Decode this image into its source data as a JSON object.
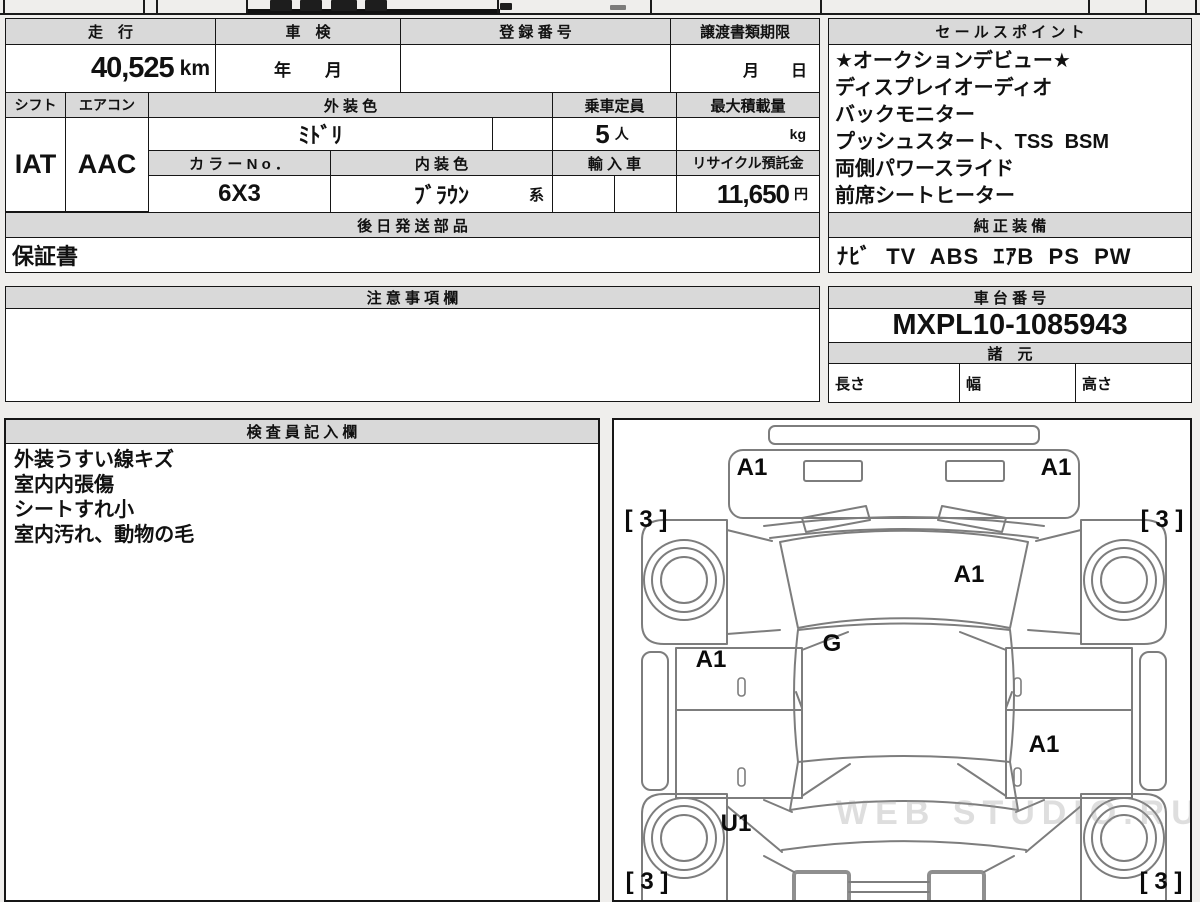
{
  "sheet": {
    "header_bg": "#d9d9d9",
    "border_color": "#161616",
    "cell_bg": "#ffffff"
  },
  "fields": {
    "mileage": {
      "label": "走　行",
      "value": "40,525",
      "unit": "km"
    },
    "shaken": {
      "label": "車　検",
      "value": "年　　月"
    },
    "registration": {
      "label": "登 録 番 号",
      "value": ""
    },
    "transfer": {
      "label": "譲渡書類期限",
      "value": "月　　日"
    },
    "shift": {
      "label": "シフト",
      "value": "IAT"
    },
    "aircon": {
      "label": "エアコン",
      "value": "AAC"
    },
    "exterior": {
      "label": "外 装 色",
      "value": "ﾐﾄﾞﾘ"
    },
    "capacity": {
      "label": "乗車定員",
      "value": "5",
      "unit": "人"
    },
    "payload": {
      "label": "最大積載量",
      "value": "",
      "unit": "kg"
    },
    "color_no": {
      "label": "カ ラ ー N o ．",
      "value": "6X3"
    },
    "interior": {
      "label": "内 装 色",
      "value": "ﾌﾞﾗｳﾝ",
      "suffix": "系"
    },
    "imported": {
      "label": "輸 入 車",
      "value": ""
    },
    "recycle": {
      "label": "リサイクル預託金",
      "value": "11,650",
      "unit": "円"
    },
    "later_parts": {
      "label": "後 日 発 送 部 品",
      "value": "保証書"
    }
  },
  "sales_points": {
    "title": "セ ー ル ス ポ イ ン ト",
    "lines": [
      "★オークションデビュー★",
      "ディスプレイオーディオ",
      "バックモニター",
      "プッシュスタート、TSS  BSM",
      "両側パワースライド",
      "前席シートヒーター"
    ]
  },
  "equipment": {
    "title": "純 正 装 備",
    "value": "ﾅﾋﾞ  TV  ABS  ｴｱB  PS  PW"
  },
  "notes": {
    "title": "注 意 事 項 欄",
    "value": ""
  },
  "chassis": {
    "title": "車 台 番 号",
    "value": "MXPL10-1085943"
  },
  "specs": {
    "title": "諸　元",
    "labels": [
      "長さ",
      "幅",
      "高さ"
    ]
  },
  "inspector": {
    "title": "検 査 員 記 入 欄",
    "lines": [
      "外装うすい線キズ",
      "室内内張傷",
      "シートすれ小",
      "室内汚れ、動物の毛"
    ]
  },
  "diagram": {
    "watermark": "WEB STUDIO.RU",
    "marks": [
      {
        "text": "A1",
        "x": 138,
        "y": 48
      },
      {
        "text": "A1",
        "x": 442,
        "y": 48
      },
      {
        "text": "[ 3 ]",
        "x": 32,
        "y": 100
      },
      {
        "text": "[ 3 ]",
        "x": 548,
        "y": 100
      },
      {
        "text": "A1",
        "x": 355,
        "y": 155
      },
      {
        "text": "G",
        "x": 218,
        "y": 224
      },
      {
        "text": "A1",
        "x": 97,
        "y": 240
      },
      {
        "text": "A1",
        "x": 430,
        "y": 325
      },
      {
        "text": "U1",
        "x": 122,
        "y": 404
      },
      {
        "text": "[ 3 ]",
        "x": 33,
        "y": 462
      },
      {
        "text": "[ 3 ]",
        "x": 547,
        "y": 462
      }
    ]
  }
}
